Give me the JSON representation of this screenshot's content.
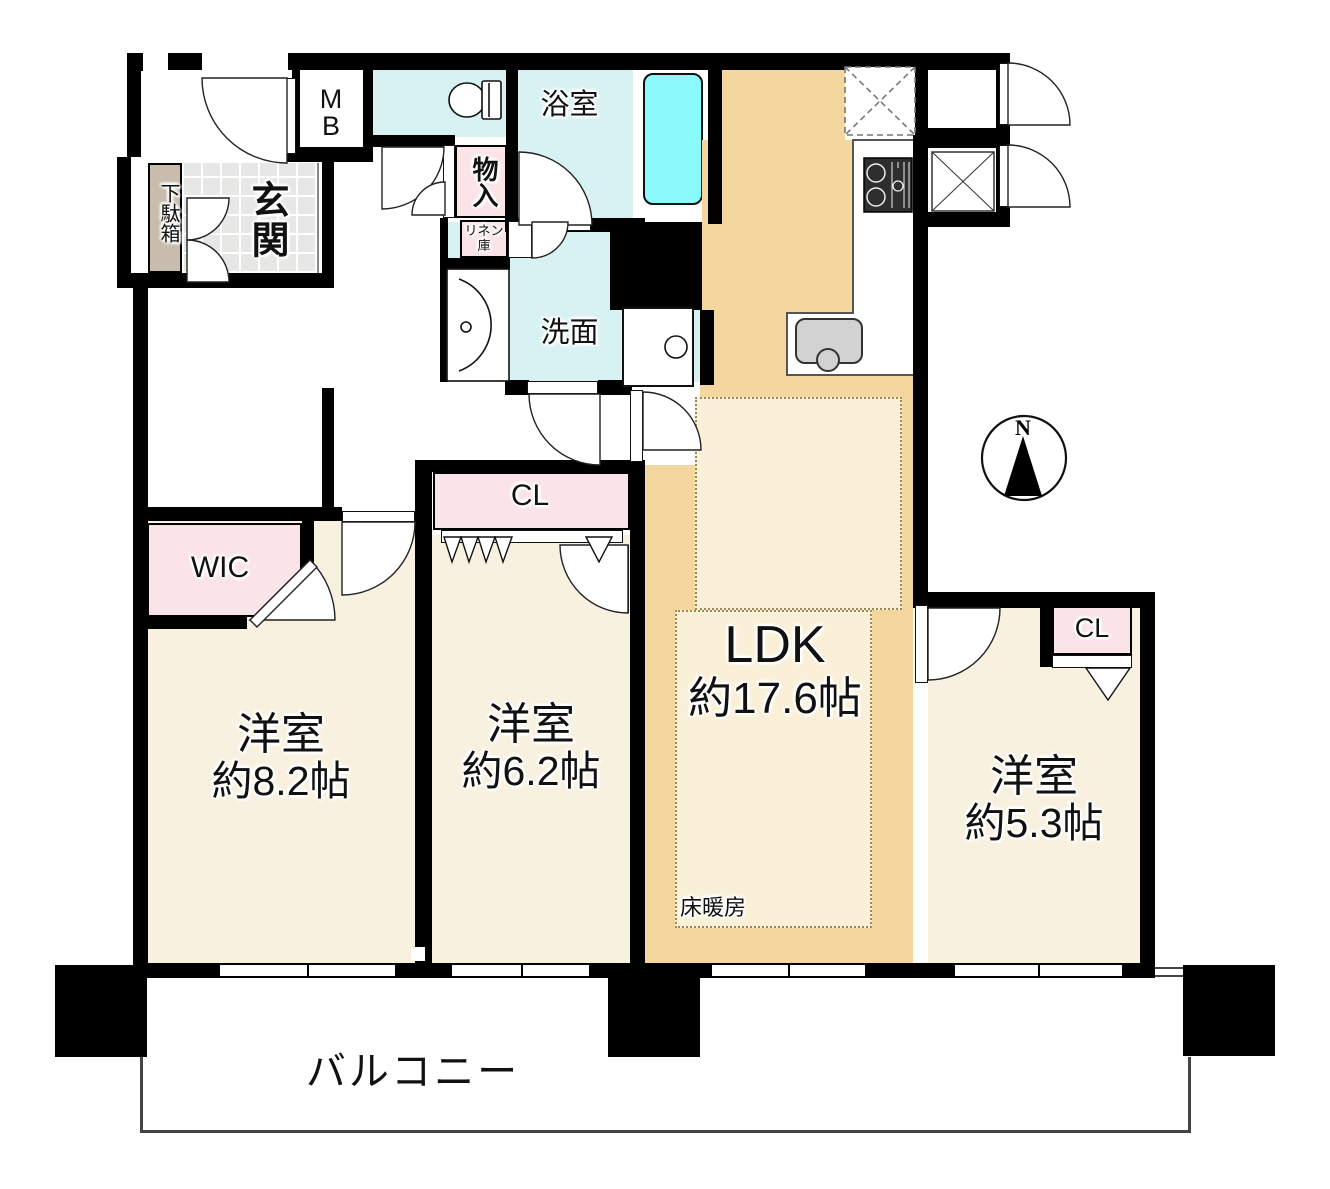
{
  "labels": {
    "ldk_name": "LDK",
    "ldk_size": "約17.6帖",
    "bedroom_82_name": "洋室",
    "bedroom_82_size": "約8.2帖",
    "bedroom_62_name": "洋室",
    "bedroom_62_size": "約6.2帖",
    "bedroom_53_name": "洋室",
    "bedroom_53_size": "約5.3帖",
    "bath": "浴室",
    "washroom": "洗面",
    "entrance": "玄関",
    "shoe_cabinet": "下駄箱",
    "meter_box": "MB",
    "storage": "物入",
    "linen_closet": "リネン庫",
    "wic": "WIC",
    "closet_62": "CL",
    "closet_53": "CL",
    "floor_heating": "床暖房",
    "balcony": "バルコニー",
    "compass_north": "N"
  },
  "colors": {
    "wall": "#000000",
    "room_cream": "#F8F1DF",
    "ldk_tan": "#F4D79F",
    "floor_heating_bg": "#FAF0D8",
    "wet_cyan": "#D8F1F3",
    "bathtub_cyan": "#8AFAFC",
    "closet_pink": "#FAE4E7",
    "shoe_tan": "#C8BCAC",
    "tile_gray": "#E7E7E5",
    "fixture_gray": "#D2D2D2"
  }
}
